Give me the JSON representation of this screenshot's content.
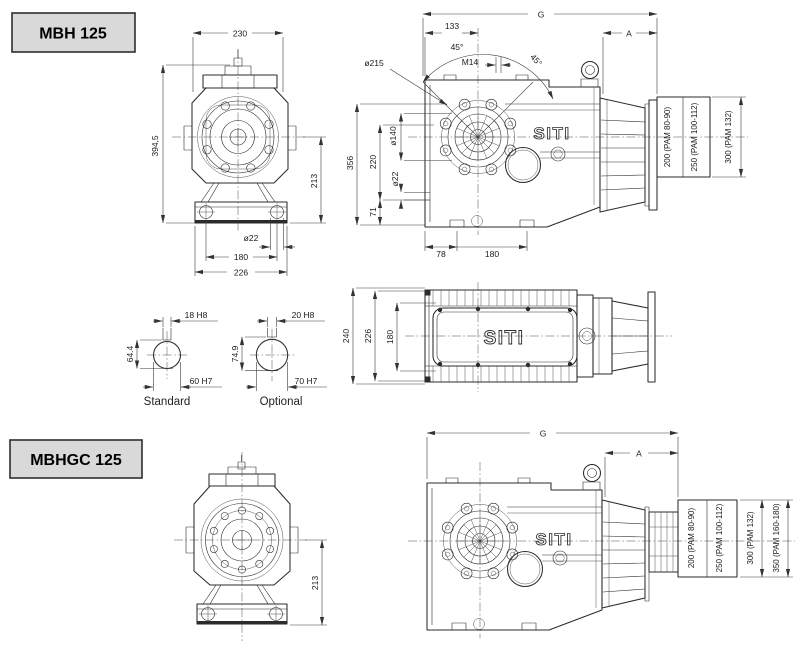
{
  "sheet": {
    "background": "#ffffff",
    "line_color": "#2b2b2b",
    "label_box_fill": "#d9d9d9"
  },
  "labels": {
    "mbh": "MBH 125",
    "mbhgc": "MBHGC 125",
    "brand": "SITI"
  },
  "mbh": {
    "front": {
      "top_width": "230",
      "overall_height": "394,5",
      "shaft_height": "213",
      "foot_hole_dia": "ø22",
      "foot_spacing": "180",
      "base_width": "226"
    },
    "side": {
      "overall_length": "G",
      "motor_length": "A",
      "input_offset": "133",
      "angle_left": "45°",
      "angle_right": "45°",
      "tap": "M14",
      "flange_dia": "ø215",
      "height": "356",
      "mid_height": "220",
      "spigot_dia": "ø140",
      "side_hole_dia": "ø22",
      "foot_height": "71",
      "foot_offset": "78",
      "foot_spacing": "180"
    },
    "pam_flanges": [
      "200 (PAM 80-90)",
      "250 (PAM 100-112)",
      "300 (PAM 132)"
    ]
  },
  "shaft_sections": {
    "standard": {
      "label": "Standard",
      "key_width": "18 H8",
      "key_depth": "64.4",
      "bore": "60 H7"
    },
    "optional": {
      "label": "Optional",
      "key_width": "20 H8",
      "key_depth": "74.9",
      "bore": "70 H7"
    }
  },
  "top_view": {
    "overall_width": "240",
    "housing_width": "226",
    "cover_width": "180"
  },
  "mbhgc": {
    "front": {
      "shaft_height": "213"
    },
    "side": {
      "overall_length": "G",
      "motor_length": "A"
    },
    "pam_flanges": [
      "200 (PAM 80-90)",
      "250 (PAM 100-112)",
      "300 (PAM 132)",
      "350 (PAM 160-180)"
    ]
  }
}
